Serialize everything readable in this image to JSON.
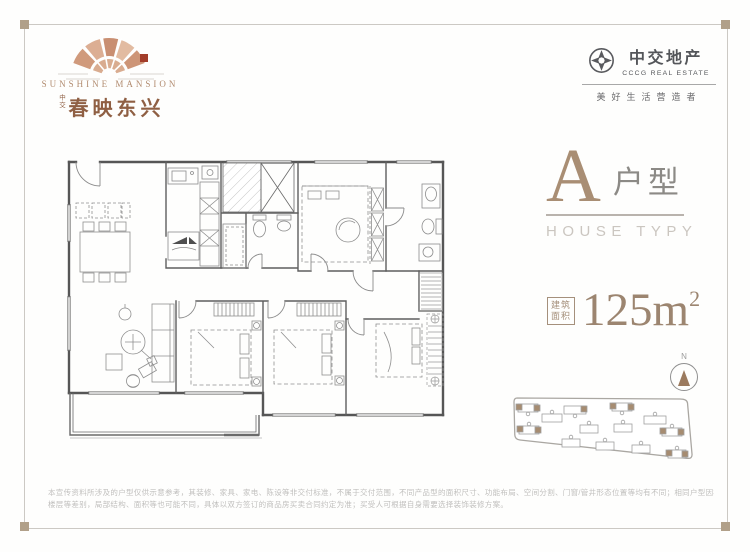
{
  "project": {
    "logo_en": "SUNSHINE MANSION",
    "logo_prefix": "中交",
    "logo_cn": "春映东兴"
  },
  "developer": {
    "name_cn": "中交地产",
    "name_en": "CCCG REAL ESTATE",
    "slogan": "美好生活营造者"
  },
  "unit": {
    "type_letter": "A",
    "type_label": "户型",
    "type_sub": "HOUSE TYPY",
    "area_label_line1": "建筑",
    "area_label_line2": "面积",
    "area_value": "125m",
    "area_sup": "2"
  },
  "compass": {
    "north_label": "N"
  },
  "disclaimer": {
    "line1": "本宣传资料所涉及的户型仅供示意参考，其装修、家具、家电、陈设等非交付标准，不属于交付范围，不同产品型的面积尺寸、功能布局、空间分割、门窗/管井形态位置等均有不同；相同户型因楼栋、单元、",
    "line2": "楼层等差别，局部结构、面积等也可能不同，具体以双方签订的商品房买卖合同约定为准；买受人可根据自身需要选择装饰装修方案。"
  },
  "colors": {
    "accent_bronze": "#a98e74",
    "brand_gray": "#54565a",
    "seal_red": "#a23d2a",
    "corner_tan": "#b1a089"
  }
}
